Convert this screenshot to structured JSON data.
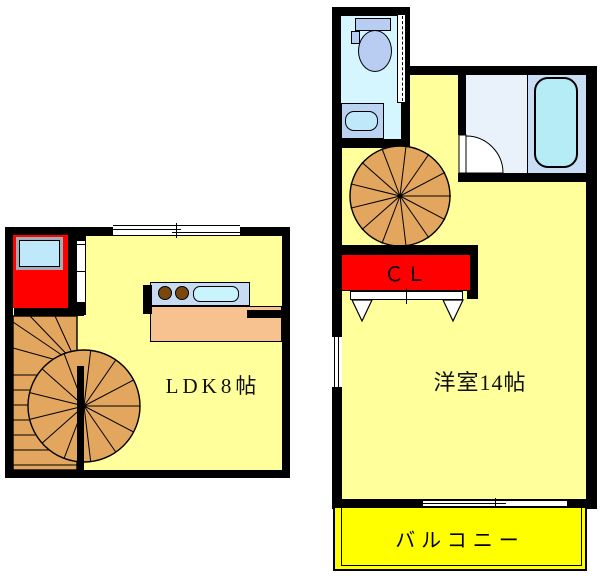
{
  "first_floor": {
    "room_label": "LDK8帖"
  },
  "second_floor": {
    "room_label": "洋室14帖",
    "closet_label": "ＣＬ",
    "balcony_label": "バルコニー"
  },
  "colors": {
    "wall_black": "#000000",
    "room_yellow": "#FFFF9C",
    "balcony_yellow": "#FFFF00",
    "entry_red": "#FF0000",
    "closet_red": "#FF0000",
    "stair_wood": "#E2A65F",
    "counter_orange": "#F7C28F",
    "kitchen_unit_blue": "#C7DCF3",
    "burner_brown": "#7A480E",
    "sink_cyan": "#C9F3FD",
    "toilet_room_cyan": "#D6F6FF",
    "fixture_blue": "#B9CDF2",
    "shower_room_blue": "#E9F1FA",
    "bath_room_blue": "#C9DDF5",
    "tub_cyan": "#B5ECF6",
    "door_frame_gray": "#A3ACB5",
    "entry_mat_blue": "#BFE9FB"
  }
}
